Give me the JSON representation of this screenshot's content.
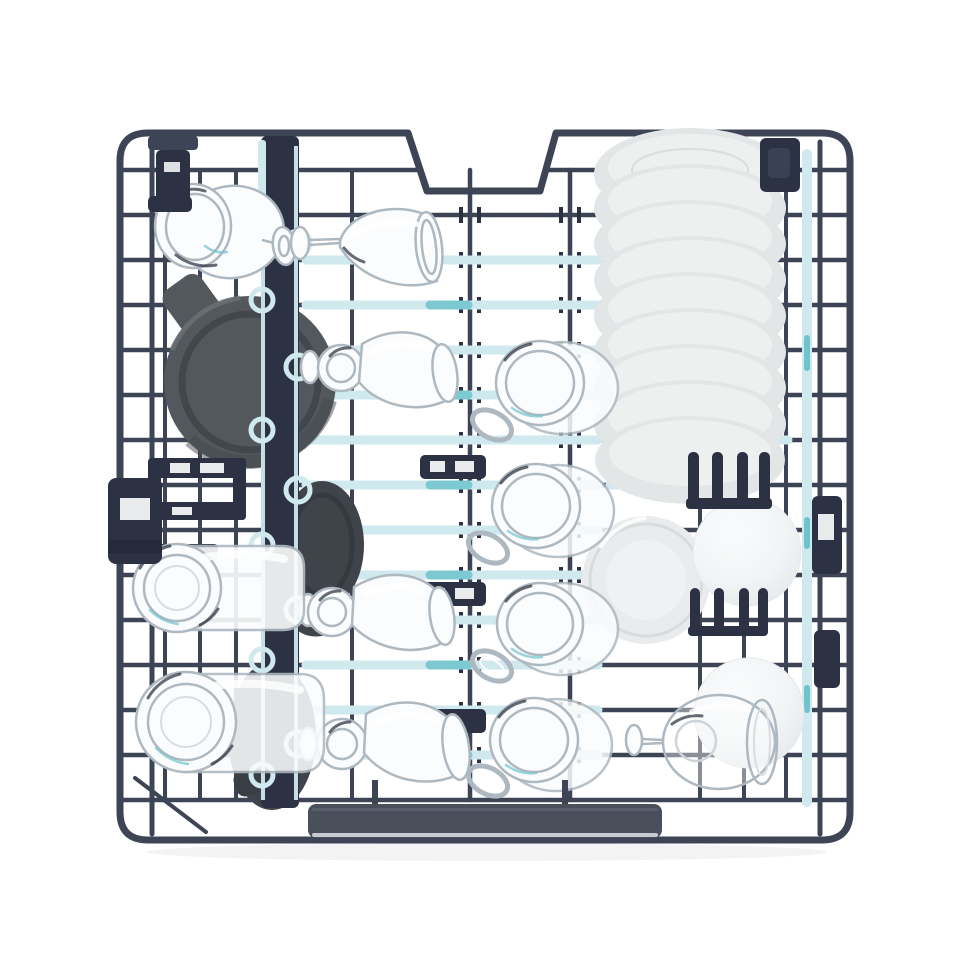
{
  "scene": {
    "type": "product-photo",
    "subject": "dishwasher rack loaded with dishes, viewed from above",
    "background": "white seamless studio background"
  },
  "colors": {
    "bg": "#ffffff",
    "wire": "#3d4456",
    "wireDark": "#2e3447",
    "plastic": "#2c3244",
    "accentLight": "#cfe9ef",
    "accentTeal": "#6fc3cd",
    "plate": "#e3e6e7",
    "plateLight": "#eef0f0",
    "plateShadow": "#c9cdcf",
    "mugDark": "#53585d",
    "mugDarker": "#3f444a",
    "glassLine": "#aeb8c0",
    "glassLineSoft": "#d7dde1",
    "glassFill": "#fbfcfd",
    "glassDark": "#262c3a",
    "handle": "#4a4f5c",
    "handleEdge": "#c6cad1"
  },
  "inventory": {
    "stemmed_glasses": 6,
    "glass_mugs_with_handles": 4,
    "glass_tumblers": 2,
    "dark_ceramic_mugs": 3,
    "stacked_plates": 9,
    "dinner_plate": 1,
    "white_bowls": 2,
    "stemware_divider": 1,
    "folding_tine_racks": 3,
    "carry_handle": 1
  }
}
